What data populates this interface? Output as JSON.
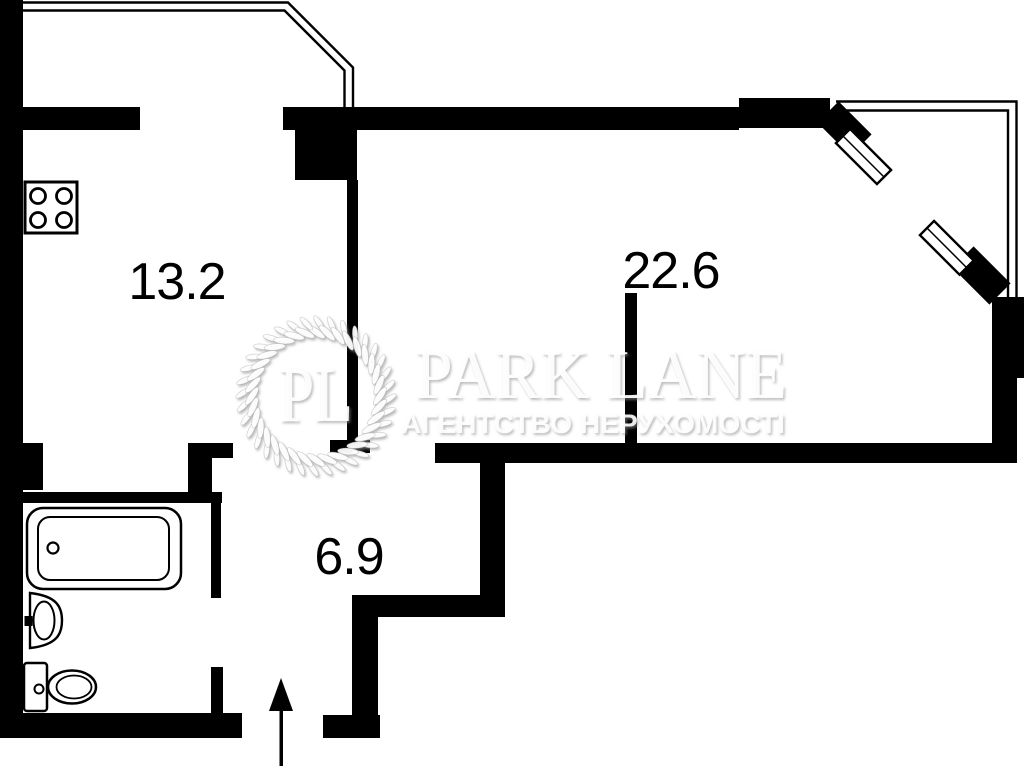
{
  "meta": {
    "background_color": "#ffffff",
    "wall_color": "#000000",
    "label_color": "#000000",
    "watermark_color": "#ffffff"
  },
  "rooms": [
    {
      "id": "kitchen",
      "area_label": "13.2"
    },
    {
      "id": "living-room",
      "area_label": "22.6"
    },
    {
      "id": "hallway",
      "area_label": "6.9"
    }
  ],
  "fixtures": [
    {
      "name": "stove-icon"
    },
    {
      "name": "bathtub-icon"
    },
    {
      "name": "sink-icon"
    },
    {
      "name": "toilet-icon"
    },
    {
      "name": "window-icon"
    },
    {
      "name": "entrance-arrow-icon"
    }
  ],
  "watermark": {
    "monogram": "PL",
    "brand": "PARK LANE",
    "tagline": "АГЕНТСТВО НЕРУХОМОСТІ"
  }
}
